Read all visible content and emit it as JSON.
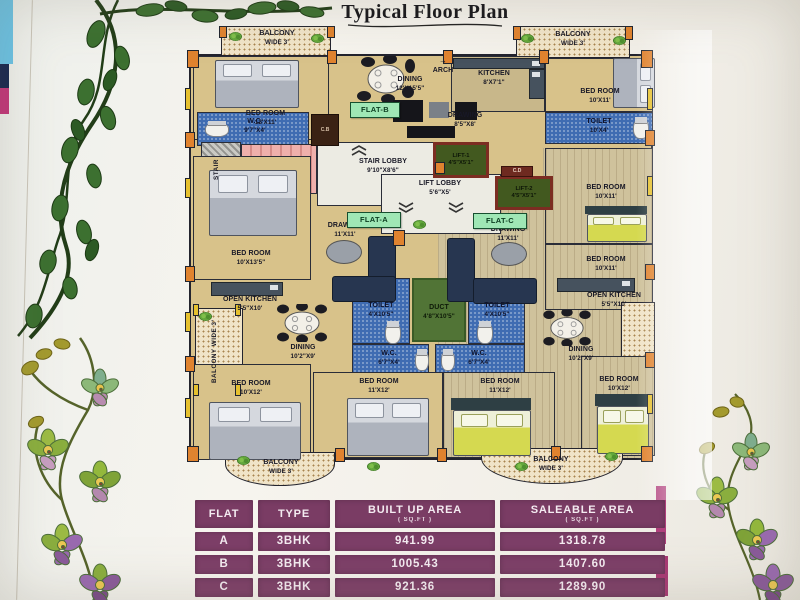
{
  "title": "Typical Floor Plan",
  "badges": {
    "flat_a": "FLAT-A",
    "flat_b": "FLAT-B",
    "flat_c": "FLAT-C"
  },
  "balcony": {
    "line1": "BALCONY",
    "line2": "WIDE 3'",
    "vertical": "BALCONY WIDE 3'"
  },
  "icons": {
    "arch_arrow": "→"
  },
  "rooms": {
    "bedroom_tl": {
      "name": "BED ROOM",
      "dims": "12'X11'"
    },
    "wc_tl": {
      "name": "W.C.",
      "dims": "9'7\"X4'"
    },
    "dining_b": {
      "name": "DINING",
      "dims": "12'X15'5\""
    },
    "arch": {
      "name": "ARCH"
    },
    "kitchen_b": {
      "name": "KITCHEN",
      "dims": "8'X7'1\""
    },
    "drawing_b": {
      "name": "DRAWING",
      "dims": "8'5\"X8'"
    },
    "bedroom_tr": {
      "name": "BED ROOM",
      "dims": "10'X11'"
    },
    "toilet_tr": {
      "name": "TOILET",
      "dims": "10'X4'"
    },
    "stair": {
      "name": "STAIR"
    },
    "stair_lobby": {
      "name": "STAIR LOBBY",
      "dims": "9'10\"X8'6\""
    },
    "lift_lobby": {
      "name": "LIFT LOBBY",
      "dims": "5'6\"X5'"
    },
    "lift1": {
      "name": "LIFT-1",
      "dims": "4'5\"X5'1\""
    },
    "lift2": {
      "name": "LIFT-2",
      "dims": "4'5\"X5'1\""
    },
    "drawing_a": {
      "name": "DRAWING",
      "dims": "11'X11'"
    },
    "drawing_c": {
      "name": "DRAWING",
      "dims": "11'X11'"
    },
    "bedroom_ml": {
      "name": "BED ROOM",
      "dims": "10'X13'5\""
    },
    "open_kitchen_l": {
      "name": "OPEN KITCHEN",
      "dims": "5'5\"X10'"
    },
    "open_kitchen_r": {
      "name": "OPEN KITCHEN",
      "dims": "5'5\"X10'"
    },
    "dining_l": {
      "name": "DINING",
      "dims": "10'2\"X9'"
    },
    "dining_r": {
      "name": "DINING",
      "dims": "10'2\"X9'"
    },
    "toilet_a": {
      "name": "TOILET",
      "dims": "4'X10'5\""
    },
    "duct": {
      "name": "DUCT",
      "dims": "4'8\"X10'5\""
    },
    "toilet_c": {
      "name": "TOILET",
      "dims": "4'X10'5\""
    },
    "wc_a": {
      "name": "W.C.",
      "dims": "6'7\"X4'"
    },
    "wc_c": {
      "name": "W.C.",
      "dims": "6'7\"X4'"
    },
    "bedroom_r1": {
      "name": "BED ROOM",
      "dims": "10'X11'"
    },
    "bedroom_r2": {
      "name": "BED ROOM",
      "dims": "10'X11'"
    },
    "bedroom_bl": {
      "name": "BED ROOM",
      "dims": "10'X12'"
    },
    "bedroom_bm1": {
      "name": "BED ROOM",
      "dims": "11'X12'"
    },
    "bedroom_bm2": {
      "name": "BED ROOM",
      "dims": "11'X12'"
    },
    "bedroom_br": {
      "name": "BED ROOM",
      "dims": "10'X12'"
    },
    "cb": "C.B",
    "cd": "C.D"
  },
  "table": {
    "headers": {
      "flat": "FLAT",
      "type": "TYPE",
      "built": "BUILT UP  AREA",
      "built_unit": "( SQ.FT )",
      "sale": "SALEABLE  AREA",
      "sale_unit": "( SQ.FT )"
    },
    "rows": [
      {
        "flat": "A",
        "type": "3BHK",
        "built": "941.99",
        "sale": "1318.78"
      },
      {
        "flat": "B",
        "type": "3BHK",
        "built": "1005.43",
        "sale": "1407.60"
      },
      {
        "flat": "C",
        "type": "3BHK",
        "built": "921.36",
        "sale": "1289.90"
      }
    ]
  },
  "colors": {
    "table_purple": "#7d3f68",
    "badge_mint": "#9fe7b5",
    "floor_tan": "#d8c28a",
    "floor_wood": "#cfc29c",
    "toilet_blue": "#3f6cb2",
    "duct_green": "#517436",
    "pillar_orange": "#e0832f",
    "stair_pink": "#efb0ac",
    "lift_green": "#42591f"
  }
}
